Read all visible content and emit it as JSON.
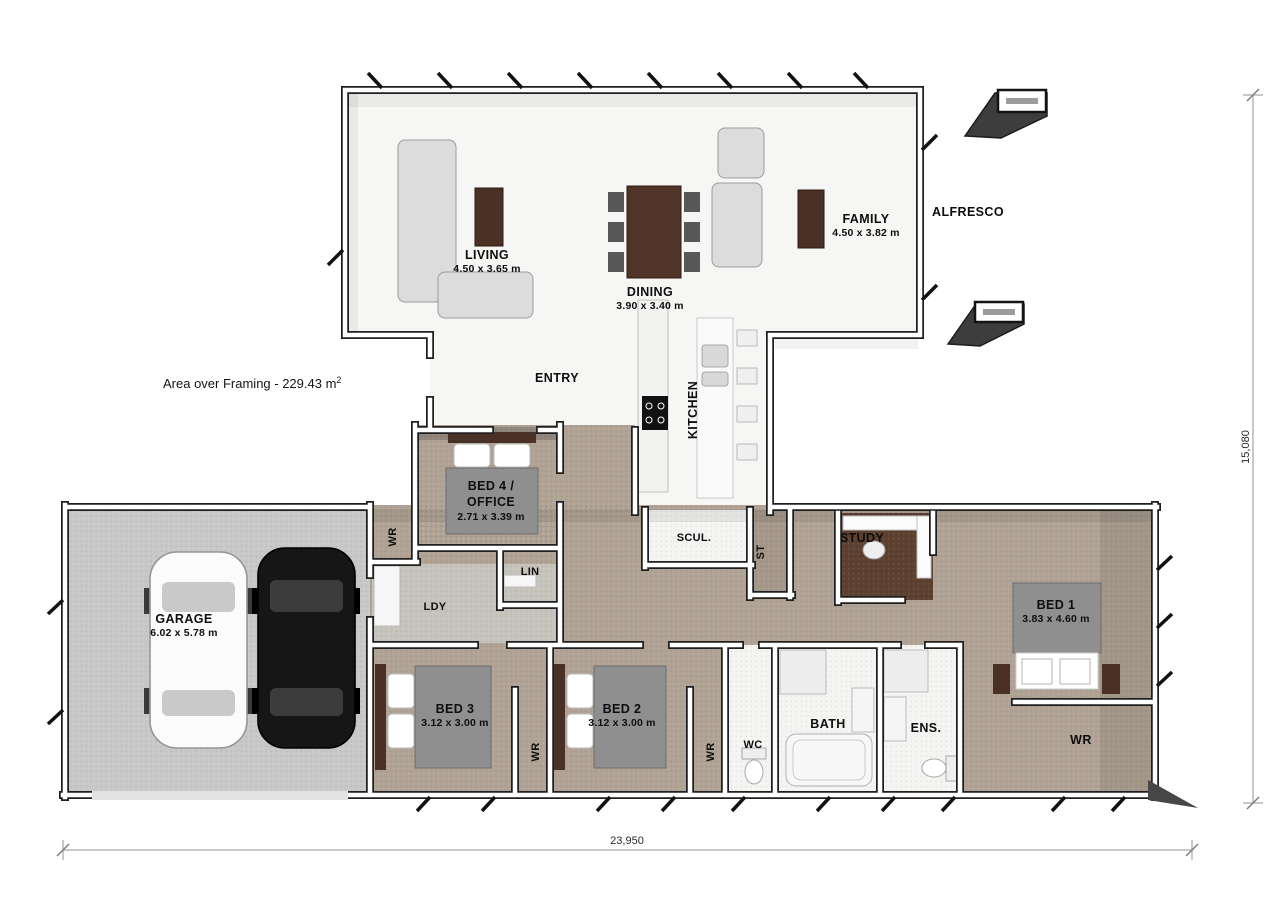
{
  "plan": {
    "area_note": "Area over Framing - 229.43 m",
    "area_note_sup": "2",
    "dim_width": "23,950",
    "dim_height": "15,080",
    "rooms": {
      "living": {
        "name": "LIVING",
        "size": "4.50 x 3.65 m"
      },
      "dining": {
        "name": "DINING",
        "size": "3.90 x 3.40 m"
      },
      "family": {
        "name": "FAMILY",
        "size": "4.50 x 3.82 m"
      },
      "alfresco": {
        "name": "ALFRESCO"
      },
      "entry": {
        "name": "ENTRY"
      },
      "kitchen": {
        "name": "KITCHEN"
      },
      "bed4": {
        "name_line1": "BED 4 /",
        "name_line2": "OFFICE",
        "size": "2.71 x 3.39 m"
      },
      "scullery": {
        "name": "SCUL."
      },
      "store": {
        "name": "ST"
      },
      "study": {
        "name": "STUDY"
      },
      "bed1": {
        "name": "BED 1",
        "size": "3.83 x 4.60 m"
      },
      "wr_hall": {
        "name": "WR"
      },
      "linen": {
        "name": "LIN"
      },
      "laundry": {
        "name": "LDY"
      },
      "garage": {
        "name": "GARAGE",
        "size": "6.02 x 5.78 m"
      },
      "bed3": {
        "name": "BED 3",
        "size": "3.12 x 3.00 m"
      },
      "bed2": {
        "name": "BED 2",
        "size": "3.12 x 3.00 m"
      },
      "wr_bed3": {
        "name": "WR"
      },
      "wr_bed2": {
        "name": "WR"
      },
      "wc": {
        "name": "WC"
      },
      "bath": {
        "name": "BATH"
      },
      "ensuite": {
        "name": "ENS."
      },
      "wr_bed1": {
        "name": "WR"
      }
    },
    "colors": {
      "carpet": "#b0a395",
      "garage_floor": "#c8c8c8",
      "white_floor": "#f6f6f4",
      "timber": "#4a3025",
      "bed_blanket": "#8f8f8f",
      "wall_edge": "#1f1f1f",
      "dim_line": "#b5b5b5"
    }
  }
}
